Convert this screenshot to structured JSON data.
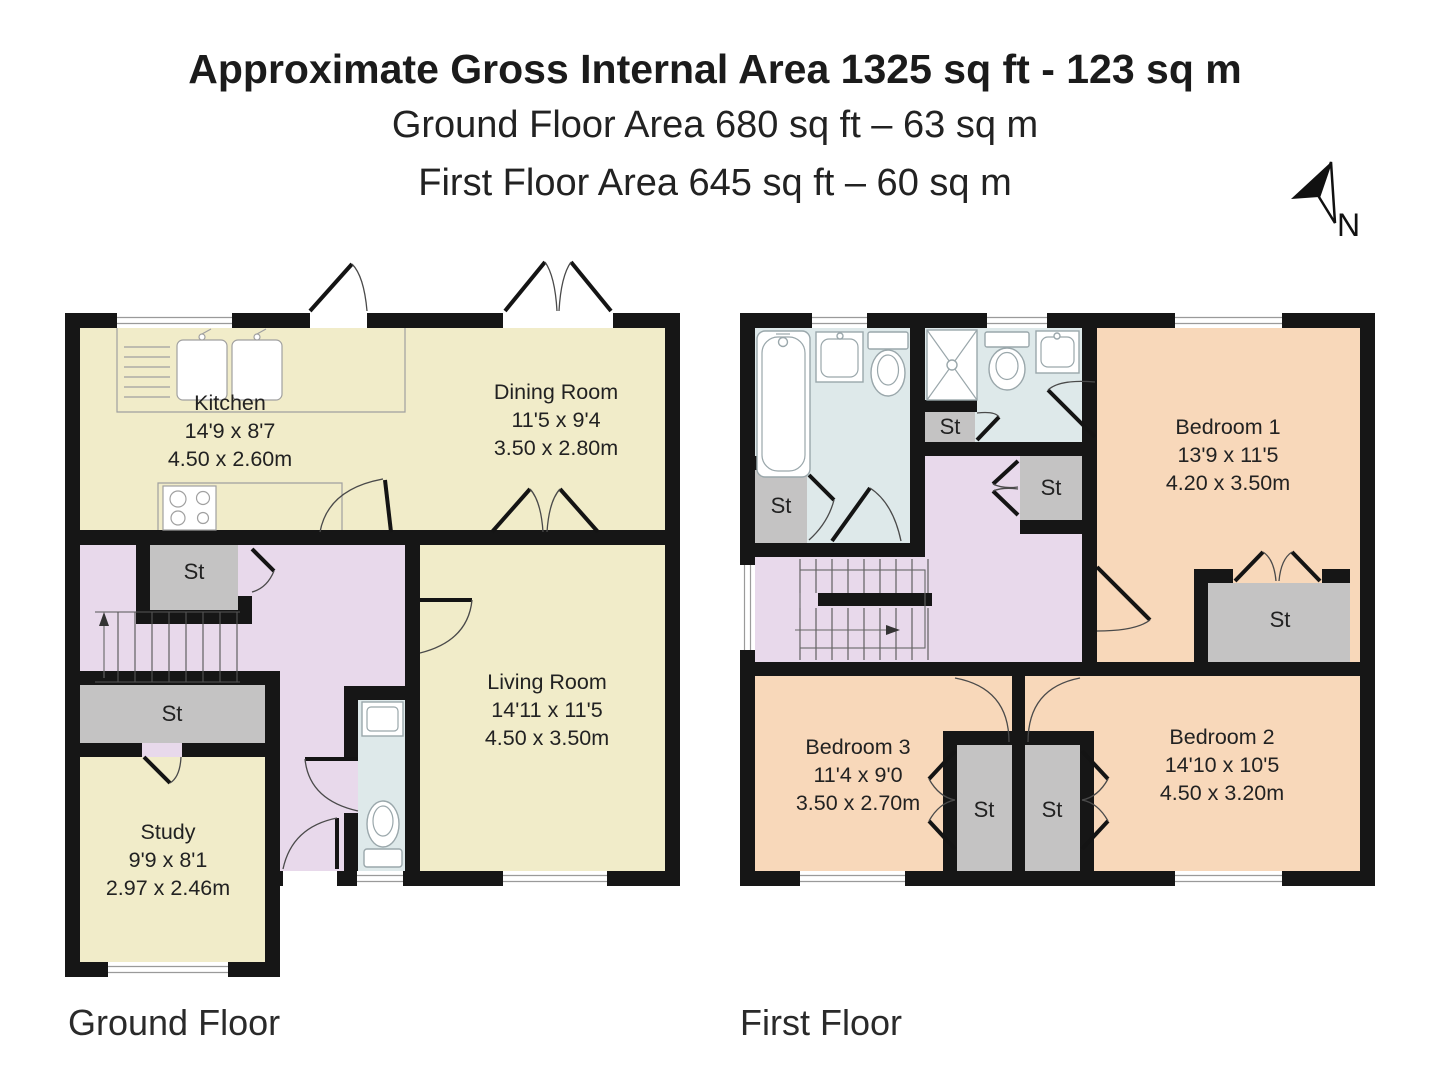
{
  "header": {
    "title": "Approximate Gross Internal Area 1325 sq ft - 123 sq m",
    "ground_line": "Ground Floor Area 680 sq ft – 63 sq m",
    "first_line": "First Floor Area 645 sq ft – 60 sq m",
    "compass": "N"
  },
  "floors": {
    "ground": {
      "label": "Ground Floor"
    },
    "first": {
      "label": "First Floor"
    }
  },
  "rooms": {
    "kitchen": {
      "name": "Kitchen",
      "imperial": "14'9 x 8'7",
      "metric": "4.50 x 2.60m"
    },
    "dining": {
      "name": "Dining Room",
      "imperial": "11'5 x 9'4",
      "metric": "3.50 x 2.80m"
    },
    "living": {
      "name": "Living Room",
      "imperial": "14'11 x 11'5",
      "metric": "4.50 x 3.50m"
    },
    "study": {
      "name": "Study",
      "imperial": "9'9 x 8'1",
      "metric": "2.97 x 2.46m"
    },
    "bedroom1": {
      "name": "Bedroom 1",
      "imperial": "13'9 x 11'5",
      "metric": "4.20 x 3.50m"
    },
    "bedroom2": {
      "name": "Bedroom 2",
      "imperial": "14'10 x 10'5",
      "metric": "4.50 x 3.20m"
    },
    "bedroom3": {
      "name": "Bedroom 3",
      "imperial": "11'4 x 9'0",
      "metric": "3.50 x 2.70m"
    }
  },
  "labels": {
    "storage": "St"
  },
  "colors": {
    "walls": "#161616",
    "living_areas": "#f1ecc9",
    "hallway": "#e8d9eb",
    "wet_rooms": "#dee9ea",
    "storage": "#c4c3c3",
    "bedrooms": "#f8d8ba"
  }
}
